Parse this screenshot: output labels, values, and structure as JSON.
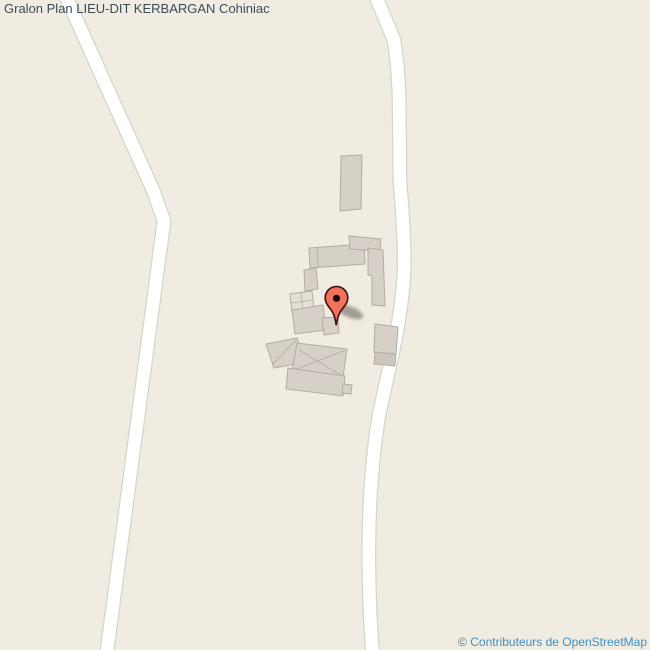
{
  "header": {
    "title": "Gralon Plan LIEU-DIT KERBARGAN Cohiniac"
  },
  "attribution": {
    "copyright": "© ",
    "link_text": "Contributeurs de OpenStreetMap"
  },
  "marker": {
    "icon": "map-marker-icon",
    "place": "LIEU-DIT KERBARGAN"
  },
  "map": {
    "colors": {
      "background": "#f0ece1",
      "road_casing": "#d9d4ca",
      "road_fill": "#ffffff",
      "building_fill": "#d7d0c9",
      "building_stroke": "#b3aba3",
      "building_light": "#e5dfd8",
      "building_dark": "#cdc5be",
      "marker_fill": "#f3705c",
      "marker_outline": "#3f0f08",
      "marker_dot": "#1c0905",
      "title_color": "#3d4a59",
      "link_color": "#3f8fc5"
    }
  }
}
